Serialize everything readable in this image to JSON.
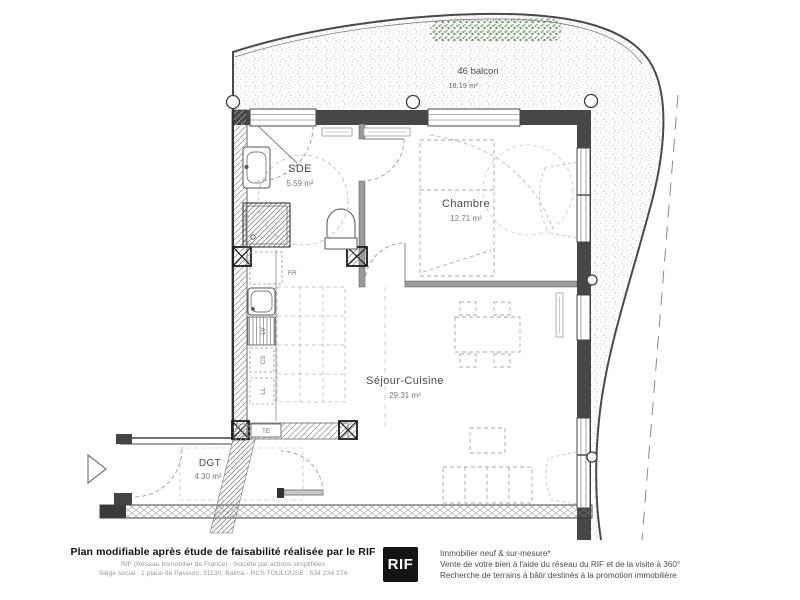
{
  "plan": {
    "balcony": {
      "label": "46 balcon",
      "area": "18.19 m²"
    },
    "rooms": {
      "sde": {
        "label": "SDE",
        "area": "5.59 m²"
      },
      "chambre": {
        "label": "Chambre",
        "area": "12.71 m²"
      },
      "sejour": {
        "label": "Séjour-Cuisine",
        "area": "29.31 m²"
      },
      "dgt": {
        "label": "DGT",
        "area": "4.30 m²"
      }
    },
    "equipment": {
      "fridge": "FR",
      "dishwasher": "LV",
      "cooktop": "CS",
      "washing_machine": "LL",
      "electrical_panel": "TE"
    }
  },
  "footer": {
    "left": {
      "title": "Plan modifiable après étude de faisabilité réalisée par le RIF",
      "line2": "RIF (Réseau Immobilier de France) - Société par actions simplifiées",
      "line3": "Siège social : 1 place de Paveurs, 31130, Balma - RCS TOULOUSE : 534 234 174"
    },
    "logo_text": "RIF",
    "right": {
      "line1": "Immobilier neuf & sur-mesure*",
      "line2": "Vente de votre bien à l'aide du réseau du RIF et de la visite à 360°",
      "line3": "Recherche de terrains à bâtir destinés à la promotion immobilière"
    }
  },
  "colors": {
    "wall": "#474747",
    "vegetation": "#7da379",
    "logo_bg": "#141414"
  }
}
